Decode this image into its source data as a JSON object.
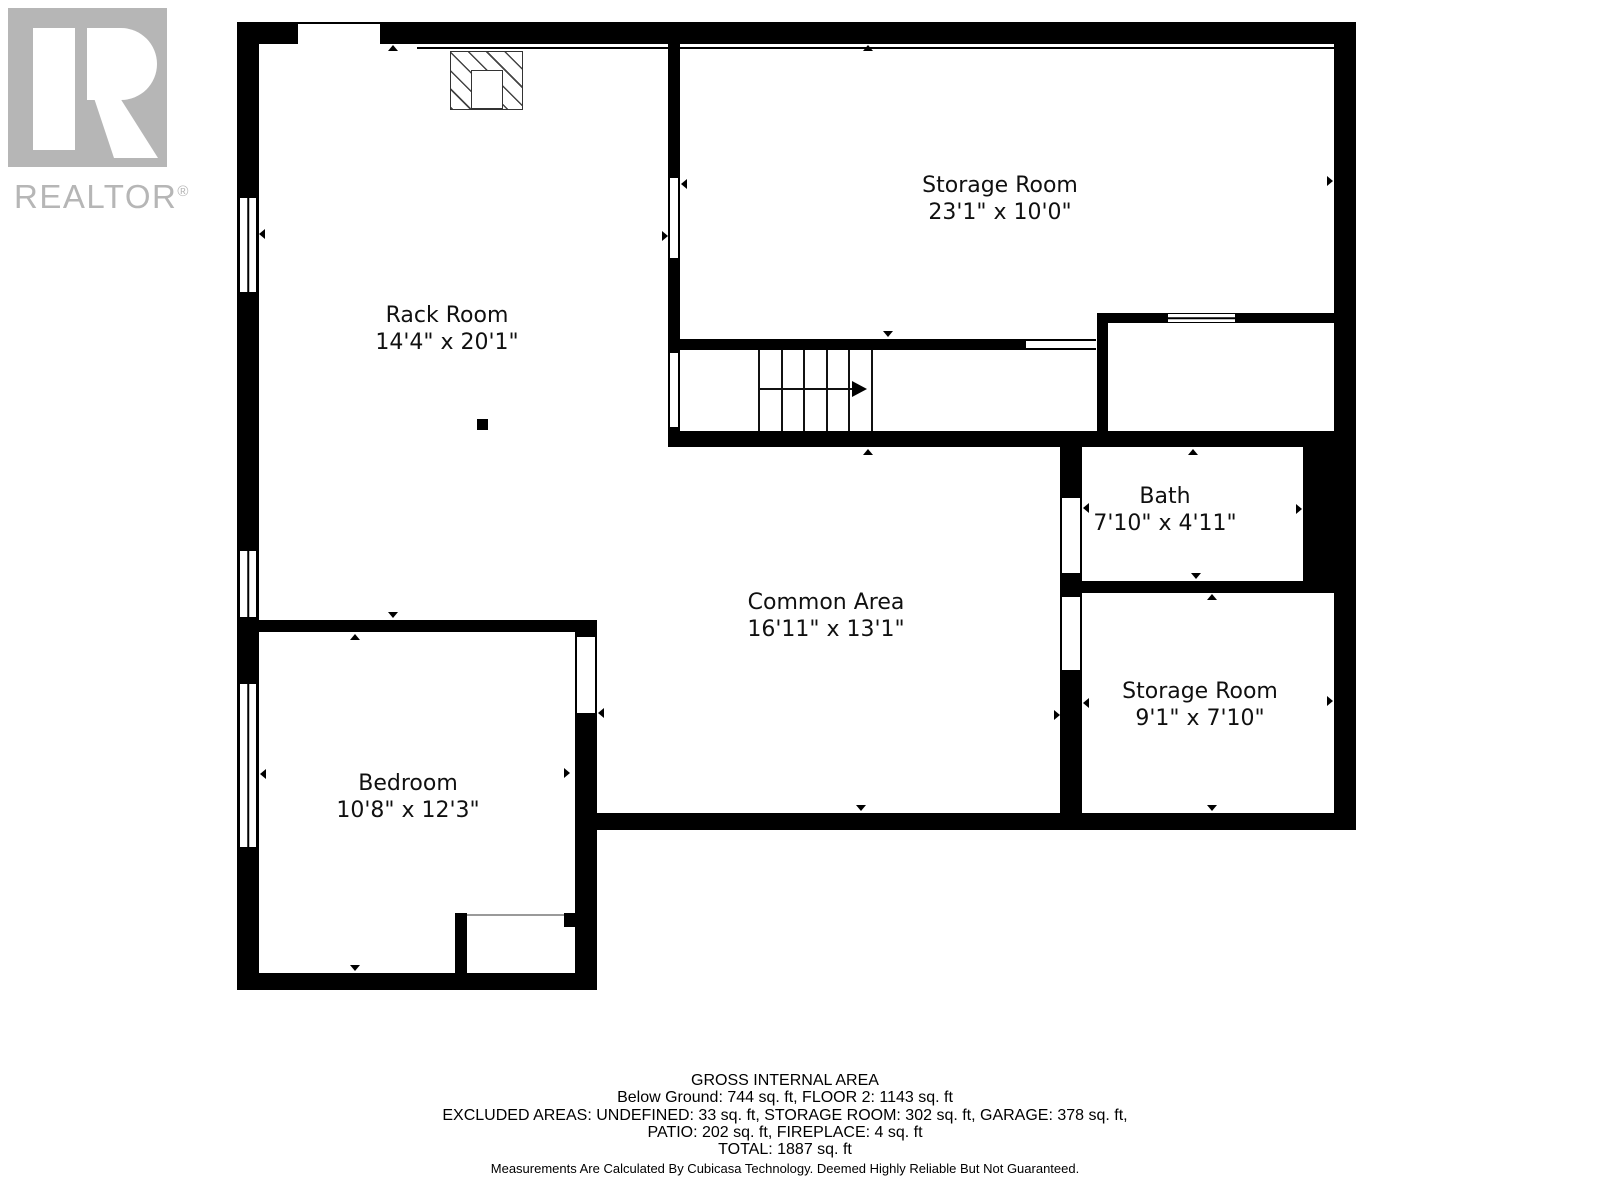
{
  "watermark": {
    "brand": "REALTOR",
    "registered": "®"
  },
  "rooms": [
    {
      "id": "rack-room",
      "name": "Rack Room",
      "dims": "14'4\" x 20'1\""
    },
    {
      "id": "storage-room-top",
      "name": "Storage Room",
      "dims": "23'1\" x 10'0\""
    },
    {
      "id": "bath",
      "name": "Bath",
      "dims": "7'10\" x 4'11\""
    },
    {
      "id": "common-area",
      "name": "Common Area",
      "dims": "16'11\" x 13'1\""
    },
    {
      "id": "storage-room-right",
      "name": "Storage Room",
      "dims": "9'1\" x 7'10\""
    },
    {
      "id": "bedroom",
      "name": "Bedroom",
      "dims": "10'8\" x 12'3\""
    }
  ],
  "footer": {
    "heading": "GROSS INTERNAL AREA",
    "line1": "Below Ground: 744 sq. ft, FLOOR 2: 1143 sq. ft",
    "line2": "EXCLUDED AREAS: UNDEFINED: 33 sq. ft, STORAGE ROOM: 302 sq. ft, GARAGE: 378 sq. ft,",
    "line3": "PATIO: 202 sq. ft, FIREPLACE: 4 sq. ft",
    "line4": "TOTAL: 1887 sq. ft",
    "disclaimer": "Measurements Are Calculated By Cubicasa Technology. Deemed Highly Reliable But Not Guaranteed."
  },
  "colors": {
    "wall": "#000000",
    "watermark": "#b6b6b6",
    "background": "#ffffff"
  }
}
